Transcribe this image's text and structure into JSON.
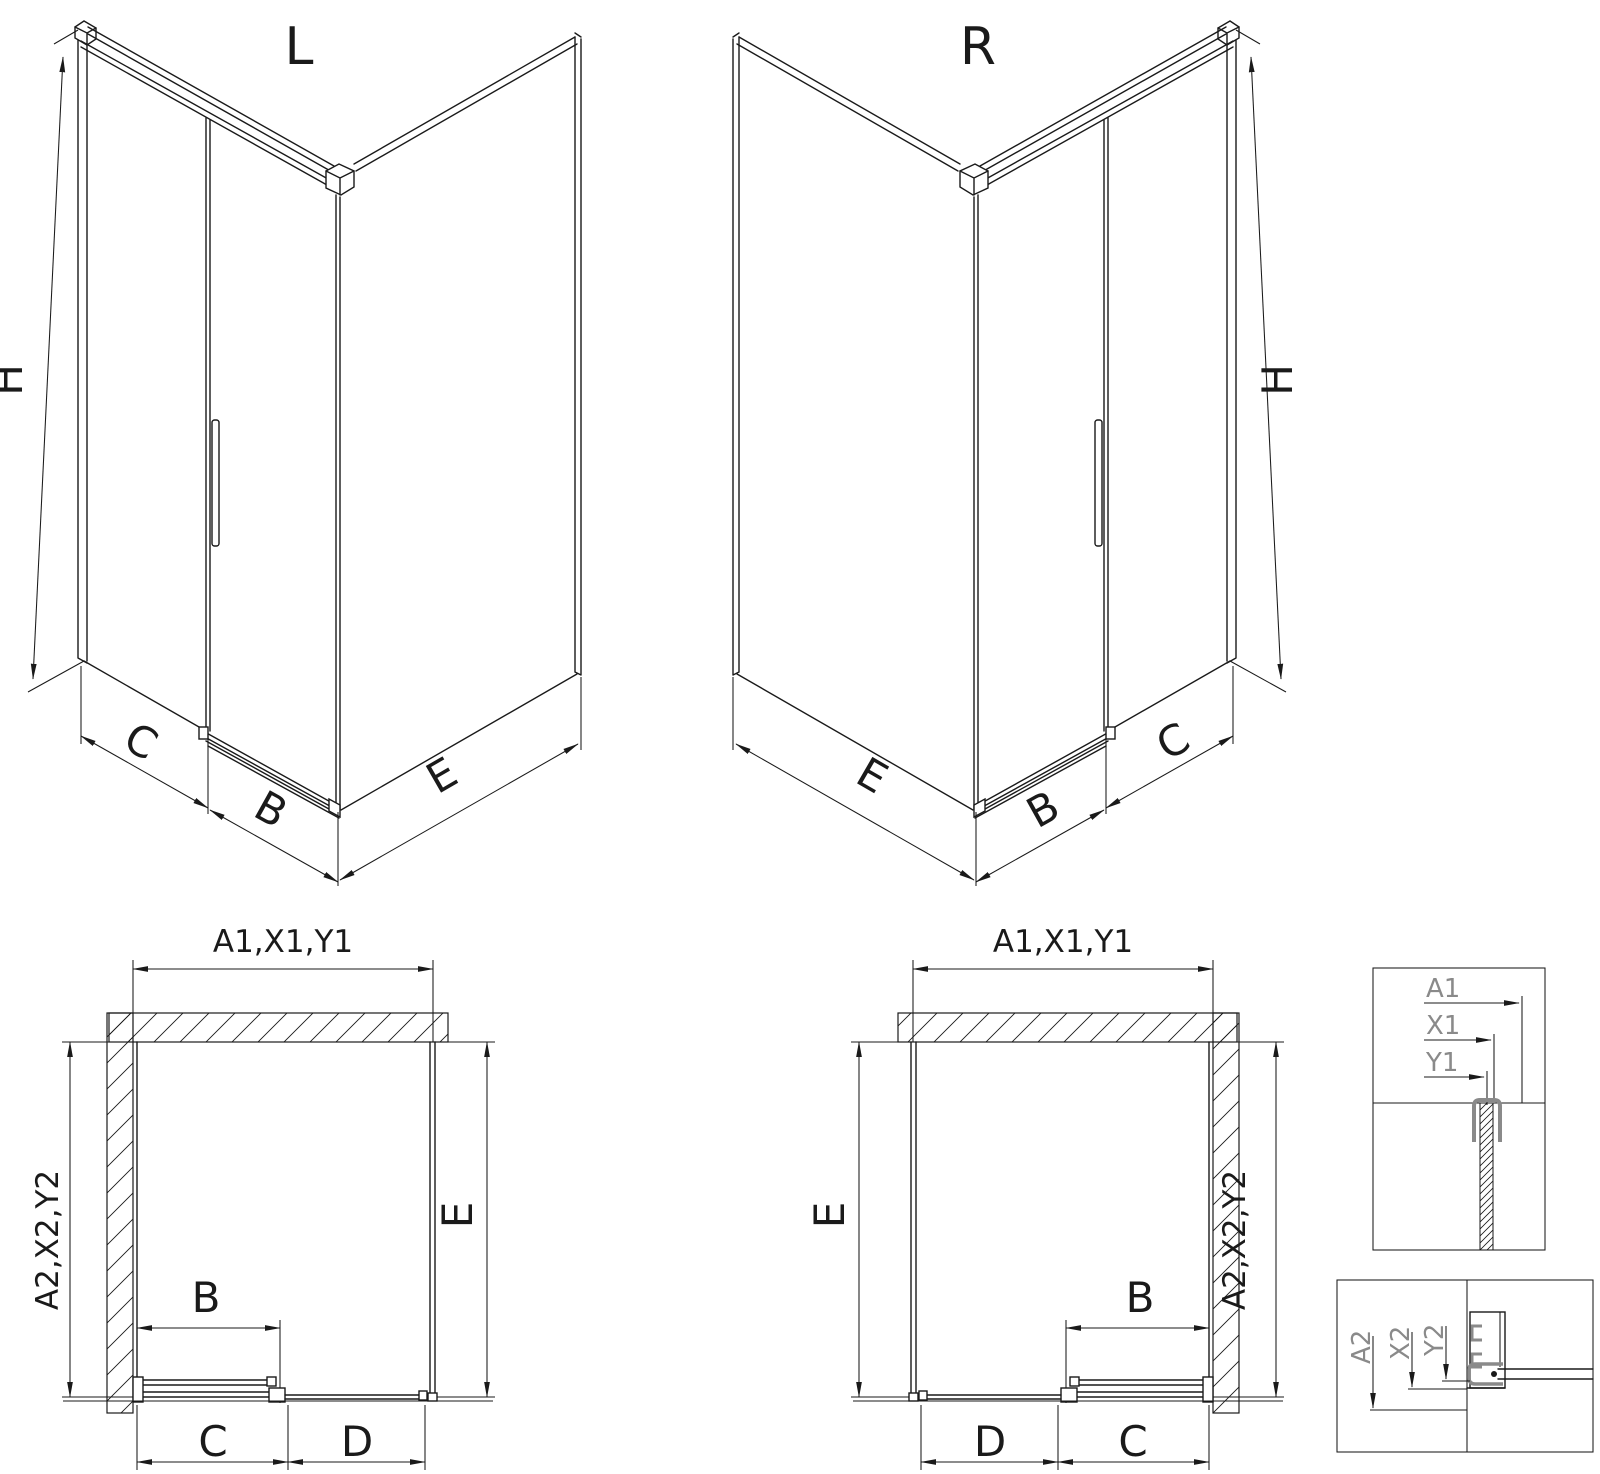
{
  "drawing": {
    "variant_left": {
      "label": "L",
      "height": "H",
      "fixed_panel": "C",
      "door": "B",
      "side_panel": "E"
    },
    "variant_right": {
      "label": "R",
      "height": "H",
      "fixed_panel": "C",
      "door": "B",
      "side_panel": "E"
    },
    "plan_left": {
      "top_width": "A1,X1,Y1",
      "depth": "A2,X2,Y2",
      "door": "B",
      "seg_near": "C",
      "seg_far": "D",
      "side": "E"
    },
    "plan_right": {
      "top_width": "A1,X1,Y1",
      "depth": "A2,X2,Y2",
      "door": "B",
      "seg_far": "D",
      "seg_near": "C",
      "side": "E"
    },
    "detail_top_labels": {
      "a1": "A1",
      "x1": "X1",
      "y1": "Y1"
    },
    "detail_bottom_labels": {
      "a2": "A2",
      "x2": "X2",
      "y2": "Y2"
    },
    "colors": {
      "line": "#1a1a1a",
      "detail_gray": "#8a8a8a",
      "background": "#ffffff"
    }
  }
}
